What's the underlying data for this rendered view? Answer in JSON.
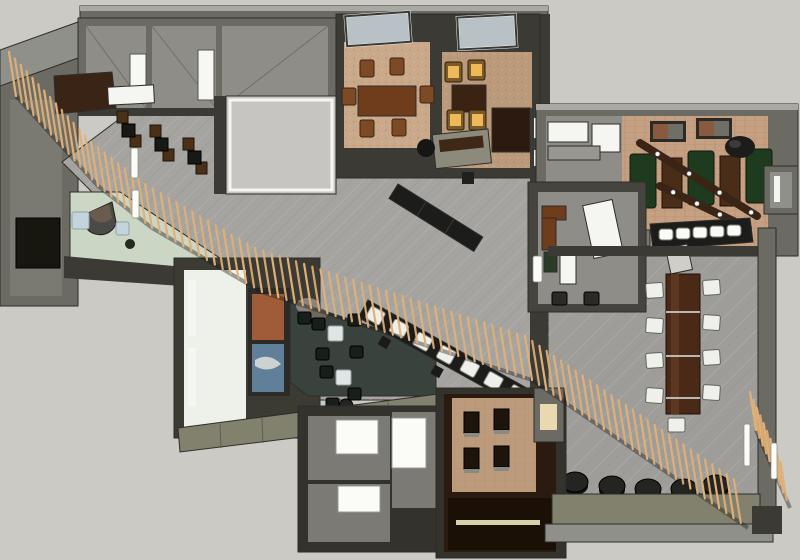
{
  "scene": {
    "kind": "3d-floorplan-render",
    "subject": "restaurant-interior-top-view"
  },
  "palette": {
    "bg": "#cbcac5",
    "wallDark": "#3b3a34",
    "wallMid": "#6b6a63",
    "wallLight": "#90908a",
    "wallTop": "#a9a8a2",
    "roomGray": "#8e8d87",
    "white": "#f5f5f2",
    "carpet": "#a5a4a0",
    "carpetLine": "#b8b7b3",
    "carpet2": "#9e9d99",
    "kitchenFloor": "#c6c5c1",
    "vestibule": "#ccd6c5",
    "lounge": "#3a423d",
    "tableWhite": "#dfe4e5",
    "chairDark": "#181e1a",
    "woodDark": "#3a2415",
    "woodMid": "#6f3c1c",
    "woodTable": "#7d4a26",
    "tanCarpet": "#c9a98a",
    "tanCarpet2": "#bb9a7b",
    "brick": "#c6a083",
    "boothGreen": "#1e3a1f",
    "amber": "#efb959",
    "slat": "#e0b077",
    "banqWhite": "#efefec",
    "counterDark": "#1c1c1a",
    "olive": "#82816d",
    "pouf": "#242422",
    "artRust": "#a05c38",
    "artBlue": "#60809a",
    "glass": "#b8c1c5",
    "woodFloor": "#2a1a0f",
    "platBrick": "#bc9b7d",
    "cream": "#ead9b0",
    "lightBlue": "#c4d4db"
  },
  "slat_screen": {
    "path": [
      [
        16,
        96
      ],
      [
        98,
        186
      ],
      [
        152,
        228
      ],
      [
        262,
        292
      ],
      [
        532,
        380
      ],
      [
        748,
        528
      ]
    ],
    "spacing": 8.5,
    "length": 44,
    "lean": -7
  },
  "slat_screen_east": {
    "path": [
      [
        756,
        430
      ],
      [
        790,
        508
      ]
    ],
    "spacing": 8,
    "length": 38,
    "lean": -6
  },
  "light_bars": [
    {
      "x": 131,
      "y": 148,
      "w": 7,
      "h": 30
    },
    {
      "x": 132,
      "y": 190,
      "w": 7,
      "h": 28
    },
    {
      "x": 744,
      "y": 424,
      "w": 6,
      "h": 42
    },
    {
      "x": 771,
      "y": 443,
      "w": 6,
      "h": 36
    },
    {
      "x": 533,
      "y": 256,
      "w": 9,
      "h": 26
    }
  ],
  "beams": [
    [
      640,
      143,
      757,
      216
    ],
    [
      660,
      186,
      748,
      228
    ]
  ],
  "beam_lights_t": [
    0.15,
    0.42,
    0.68,
    0.95
  ],
  "furniture": {
    "two_top_tables": [
      [
        122,
        124
      ],
      [
        155,
        138
      ],
      [
        188,
        151
      ]
    ],
    "lounge_tables": [
      [
        328,
        326
      ],
      [
        336,
        370
      ]
    ],
    "lounge_chairs": [
      [
        312,
        318
      ],
      [
        348,
        314
      ],
      [
        316,
        348
      ],
      [
        350,
        346
      ],
      [
        320,
        366
      ],
      [
        348,
        388
      ],
      [
        326,
        398
      ],
      [
        298,
        312
      ]
    ],
    "lounge_poufs": [
      [
        346,
        406
      ],
      [
        374,
        414
      ]
    ],
    "banquette_units": 7,
    "communal_chairs_left": [
      [
        646,
        283
      ],
      [
        646,
        318
      ],
      [
        646,
        353
      ],
      [
        646,
        388
      ]
    ],
    "communal_chairs_right": [
      [
        703,
        280
      ],
      [
        703,
        315
      ],
      [
        703,
        350
      ],
      [
        703,
        385
      ]
    ],
    "communal_chair_end": [
      668,
      418
    ],
    "bar_stools": [
      [
        659,
        229
      ],
      [
        676,
        228
      ],
      [
        693,
        227
      ],
      [
        710,
        226
      ],
      [
        727,
        225
      ]
    ],
    "booths": [
      [
        630,
        154
      ],
      [
        688,
        151
      ],
      [
        746,
        149
      ]
    ],
    "booth_tables": [
      [
        662,
        158
      ],
      [
        720,
        156
      ]
    ],
    "poufs": [
      [
        575,
        482
      ],
      [
        612,
        486
      ],
      [
        648,
        489
      ],
      [
        684,
        489
      ],
      [
        716,
        485
      ]
    ],
    "amber_chairs": [
      [
        445,
        62
      ],
      [
        468,
        60
      ],
      [
        447,
        110
      ],
      [
        469,
        110
      ]
    ],
    "wood_chairs": [
      [
        360,
        60
      ],
      [
        390,
        58
      ],
      [
        360,
        120
      ],
      [
        392,
        119
      ],
      [
        342,
        88
      ],
      [
        420,
        86
      ]
    ],
    "platform_tables": [
      [
        464,
        412
      ],
      [
        494,
        409
      ],
      [
        464,
        448
      ],
      [
        494,
        446
      ]
    ],
    "office_stools": [
      [
        552,
        292
      ],
      [
        584,
        292
      ]
    ],
    "pictures": [
      [
        650,
        121
      ],
      [
        696,
        118
      ]
    ],
    "restroom_panels": [
      [
        336,
        420,
        42,
        34
      ],
      [
        392,
        418,
        34,
        50
      ],
      [
        338,
        486,
        42,
        26
      ]
    ],
    "room_door_panels": [
      [
        130,
        54,
        16,
        46
      ],
      [
        198,
        50,
        16,
        50
      ]
    ],
    "corridor_door_slivers": [
      [
        534,
        118,
        8,
        20
      ],
      [
        534,
        150,
        8,
        16
      ]
    ],
    "vestibule_mats": [
      [
        72,
        212,
        17,
        17
      ],
      [
        116,
        222,
        13,
        13
      ]
    ]
  }
}
